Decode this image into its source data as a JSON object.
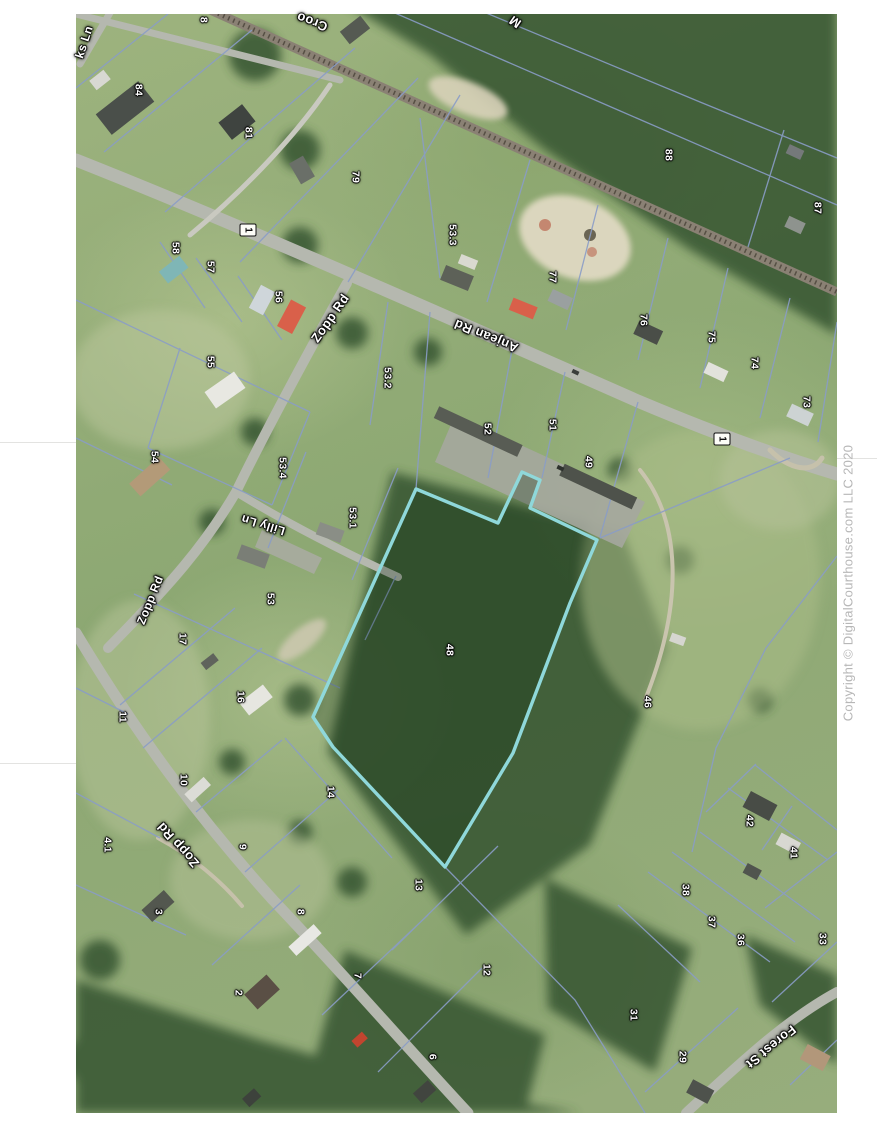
{
  "page": {
    "background": "#ffffff"
  },
  "copyright": {
    "text": "Copyright © DigitalCourthouse.com LLC 2020",
    "color": "#b7b7b7",
    "x": 848,
    "y": 583,
    "rotation": -90
  },
  "map": {
    "highlight_color": "#8fd8da",
    "parcel_line_color": "#8a9cc6",
    "route_badges": [
      {
        "label": "1",
        "x": 248,
        "y": 230,
        "rotation": 90
      },
      {
        "label": "1",
        "x": 722,
        "y": 439,
        "rotation": 90
      }
    ],
    "road_labels": [
      {
        "name": "Anjean Rd",
        "x": 486,
        "y": 336,
        "rotation": 202,
        "size": 13
      },
      {
        "name": "Zopp Rd",
        "x": 330,
        "y": 318,
        "rotation": -55,
        "size": 13
      },
      {
        "name": "Zopp Rd",
        "x": 150,
        "y": 600,
        "rotation": -68,
        "size": 12
      },
      {
        "name": "Zopp Rd",
        "x": 178,
        "y": 845,
        "rotation": 228,
        "size": 13
      },
      {
        "name": "Lilly Ln",
        "x": 263,
        "y": 525,
        "rotation": 197,
        "size": 12
      },
      {
        "name": "Forest St",
        "x": 771,
        "y": 1047,
        "rotation": 141,
        "size": 13
      },
      {
        "name": "ks Ln",
        "x": 84,
        "y": 42,
        "rotation": -72,
        "size": 12
      },
      {
        "name": "Croo",
        "x": 312,
        "y": 22,
        "rotation": 200,
        "size": 13
      },
      {
        "name": "M",
        "x": 515,
        "y": 22,
        "rotation": 215,
        "size": 13
      }
    ],
    "parcels": [
      {
        "n": "8",
        "x": 203,
        "y": 20
      },
      {
        "n": "84",
        "x": 138,
        "y": 90
      },
      {
        "n": "81",
        "x": 248,
        "y": 133
      },
      {
        "n": "79",
        "x": 355,
        "y": 177
      },
      {
        "n": "88",
        "x": 668,
        "y": 155
      },
      {
        "n": "87",
        "x": 817,
        "y": 208
      },
      {
        "n": "53.3",
        "x": 452,
        "y": 235
      },
      {
        "n": "77",
        "x": 552,
        "y": 277
      },
      {
        "n": "58",
        "x": 175,
        "y": 248
      },
      {
        "n": "57",
        "x": 210,
        "y": 267
      },
      {
        "n": "56",
        "x": 278,
        "y": 297
      },
      {
        "n": "55",
        "x": 210,
        "y": 362
      },
      {
        "n": "76",
        "x": 643,
        "y": 320
      },
      {
        "n": "75",
        "x": 711,
        "y": 337
      },
      {
        "n": "74",
        "x": 754,
        "y": 363
      },
      {
        "n": "73",
        "x": 806,
        "y": 402
      },
      {
        "n": "53.2",
        "x": 387,
        "y": 378
      },
      {
        "n": "52",
        "x": 487,
        "y": 429
      },
      {
        "n": "51",
        "x": 552,
        "y": 425
      },
      {
        "n": "49",
        "x": 588,
        "y": 462
      },
      {
        "n": "54",
        "x": 154,
        "y": 457
      },
      {
        "n": "53.4",
        "x": 282,
        "y": 468
      },
      {
        "n": "53.1",
        "x": 352,
        "y": 518
      },
      {
        "n": "53",
        "x": 270,
        "y": 599
      },
      {
        "n": "17",
        "x": 182,
        "y": 639
      },
      {
        "n": "16",
        "x": 240,
        "y": 697
      },
      {
        "n": "11",
        "x": 122,
        "y": 717
      },
      {
        "n": "10",
        "x": 183,
        "y": 780
      },
      {
        "n": "14",
        "x": 330,
        "y": 792
      },
      {
        "n": "48",
        "x": 449,
        "y": 650
      },
      {
        "n": "46",
        "x": 647,
        "y": 702
      },
      {
        "n": "4.1",
        "x": 107,
        "y": 845
      },
      {
        "n": "9",
        "x": 242,
        "y": 847
      },
      {
        "n": "3",
        "x": 158,
        "y": 912
      },
      {
        "n": "8",
        "x": 300,
        "y": 912
      },
      {
        "n": "2",
        "x": 238,
        "y": 993
      },
      {
        "n": "7",
        "x": 357,
        "y": 976
      },
      {
        "n": "13",
        "x": 418,
        "y": 885
      },
      {
        "n": "12",
        "x": 486,
        "y": 970
      },
      {
        "n": "6",
        "x": 432,
        "y": 1057
      },
      {
        "n": "42",
        "x": 749,
        "y": 821
      },
      {
        "n": "41",
        "x": 793,
        "y": 853
      },
      {
        "n": "38",
        "x": 685,
        "y": 890
      },
      {
        "n": "37",
        "x": 711,
        "y": 922
      },
      {
        "n": "36",
        "x": 740,
        "y": 940
      },
      {
        "n": "33",
        "x": 822,
        "y": 939
      },
      {
        "n": "31",
        "x": 633,
        "y": 1015
      },
      {
        "n": "29",
        "x": 682,
        "y": 1057
      }
    ]
  }
}
